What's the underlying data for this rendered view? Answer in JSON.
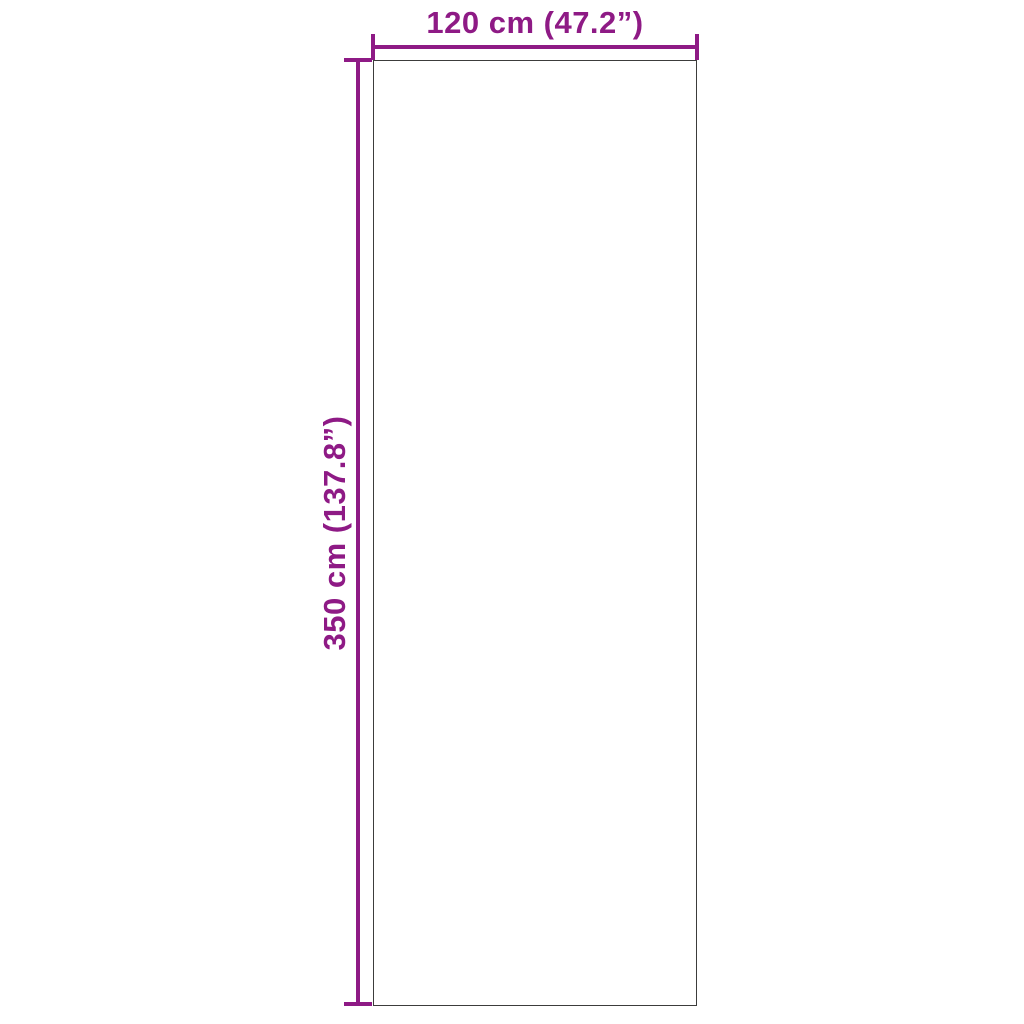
{
  "diagram": {
    "type": "product-dimension-diagram",
    "width_dimension": {
      "label": "120 cm (47.2”)",
      "value_cm": 120,
      "value_inches": 47.2
    },
    "height_dimension": {
      "label": "350 cm (137.8”)",
      "value_cm": 350,
      "value_inches": 137.8
    },
    "colors": {
      "dimension_accent": "#8E1A85",
      "outline": "#3C3C3B",
      "background": "#FFFFFF"
    }
  }
}
